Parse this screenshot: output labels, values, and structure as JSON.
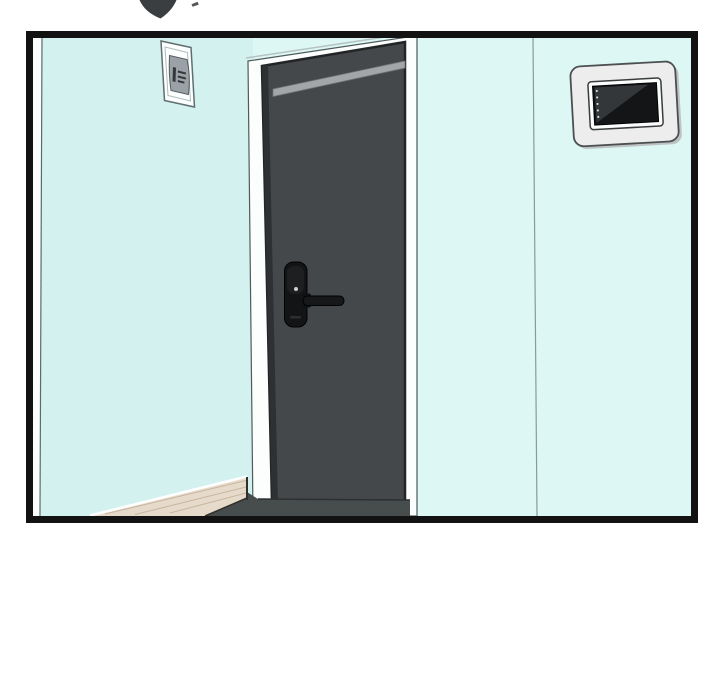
{
  "panel": {
    "label": "comic-panel-hallway-door",
    "border_color": "#121212",
    "page_background": "#ffffff"
  },
  "scene": {
    "elements": [
      "sfx-fragment",
      "left-wall",
      "right-wall",
      "wall-sign",
      "door-frame",
      "door",
      "door-lock",
      "door-lever",
      "intercom-panel",
      "wood-floor",
      "threshold"
    ]
  },
  "colors": {
    "sfx_ink": "#3b3e41",
    "sfx_ink_light": "#54575a",
    "left_wall": "#d3f2ef",
    "right_wall": "#dcf7f4",
    "wall_edge_white": "#fbfdfd",
    "wall_edge_line": "#5c6a6b",
    "wall_seam": "#8a9a99",
    "door_frame": "#fcfdfd",
    "door_frame_line": "#4f5a5a",
    "door_frame_topline": "#b7c3c3",
    "door_face": "#45484b",
    "door_edge": "#222426",
    "door_edge_shadow": "#2e3133",
    "door_bevel": "#a2a6a9",
    "door_bevel_line": "#6f7476",
    "lock_body": "#131415",
    "lock_plate": "#1d1f20",
    "lock_dot": "#caced0",
    "lock_slot": "#2c2e30",
    "lever": "#17181a",
    "lever_base": "#0f1011",
    "outline_black": "#000000",
    "floor_wood": "#e6dbca",
    "floor_grain": "#c9b7a2",
    "floor_highlight": "#ffffff",
    "floor_edge_dark": "#30302c",
    "threshold": "#474c4c",
    "threshold_line": "#2c3030",
    "sign_face": "#fdfefe",
    "sign_border": "#5f6e70",
    "sign_inner_line": "#aebcbd",
    "sign_plate": "#9aa2a7",
    "sign_plate_line": "#565e60",
    "sign_marks": "#34383a",
    "intercom_body": "#ededee",
    "intercom_depth": "#bfc2c3",
    "intercom_border": "#4c4f50",
    "intercom_frame": "#fbfcfc",
    "intercom_frame_line": "#3a3d3e",
    "screen": "#131517",
    "screen_reflection": "#33373a",
    "screen_dots": "#d8dadb"
  }
}
